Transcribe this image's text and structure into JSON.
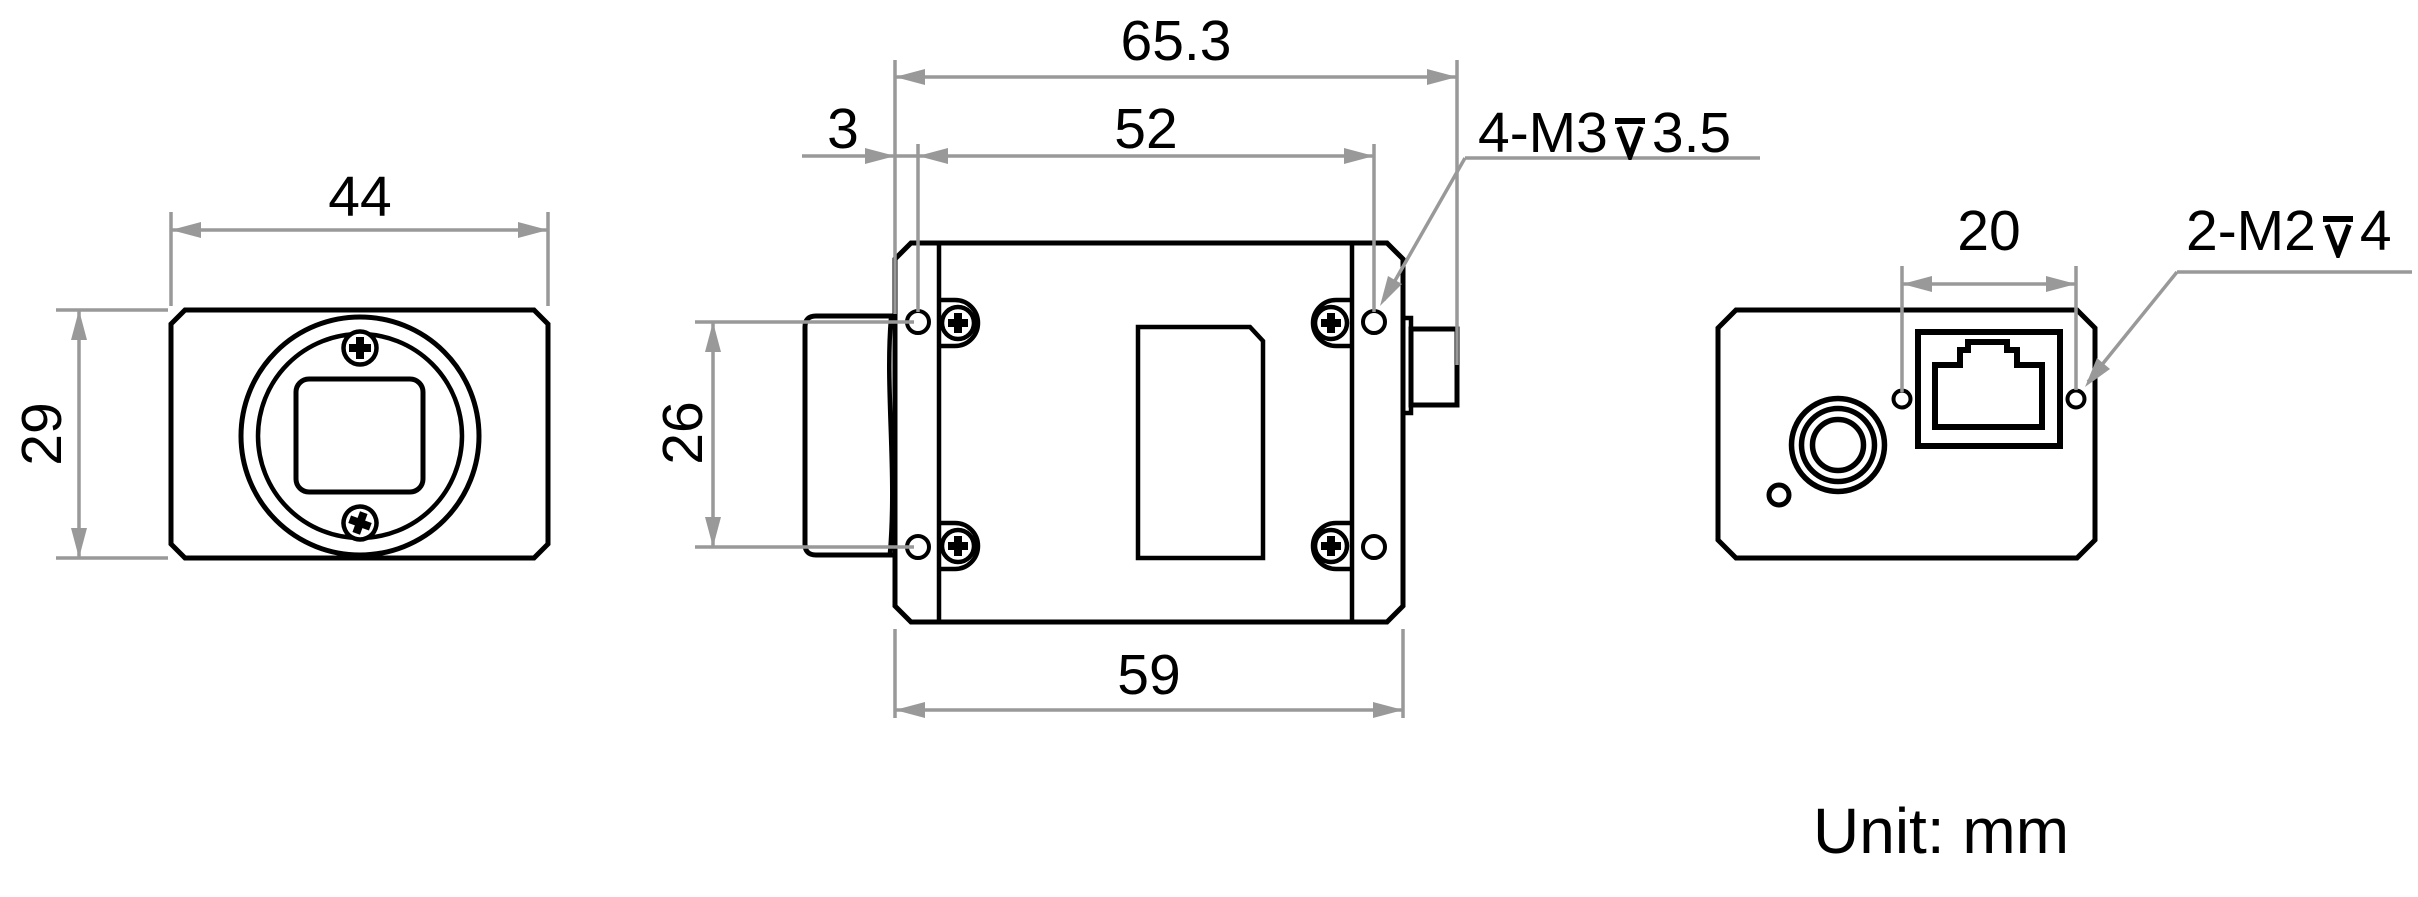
{
  "drawing": {
    "unit_note": "Unit: mm",
    "colors": {
      "outline": "#000000",
      "dimension_lines": "#999999",
      "text": "#000000",
      "background": "#ffffff"
    },
    "front_view": {
      "width_mm": "44",
      "height_mm": "29"
    },
    "top_view": {
      "overall_length_mm": "65.3",
      "front_hole_offset_mm": "3",
      "hole_span_length_mm": "52",
      "hole_span_width_mm": "26",
      "body_length_mm": "59",
      "thread_callout": {
        "prefix": "4-M3",
        "depth_mm": "3.5"
      }
    },
    "rear_view": {
      "hole_span_mm": "20",
      "thread_callout": {
        "prefix": "2-M2",
        "depth_mm": "4"
      }
    }
  }
}
